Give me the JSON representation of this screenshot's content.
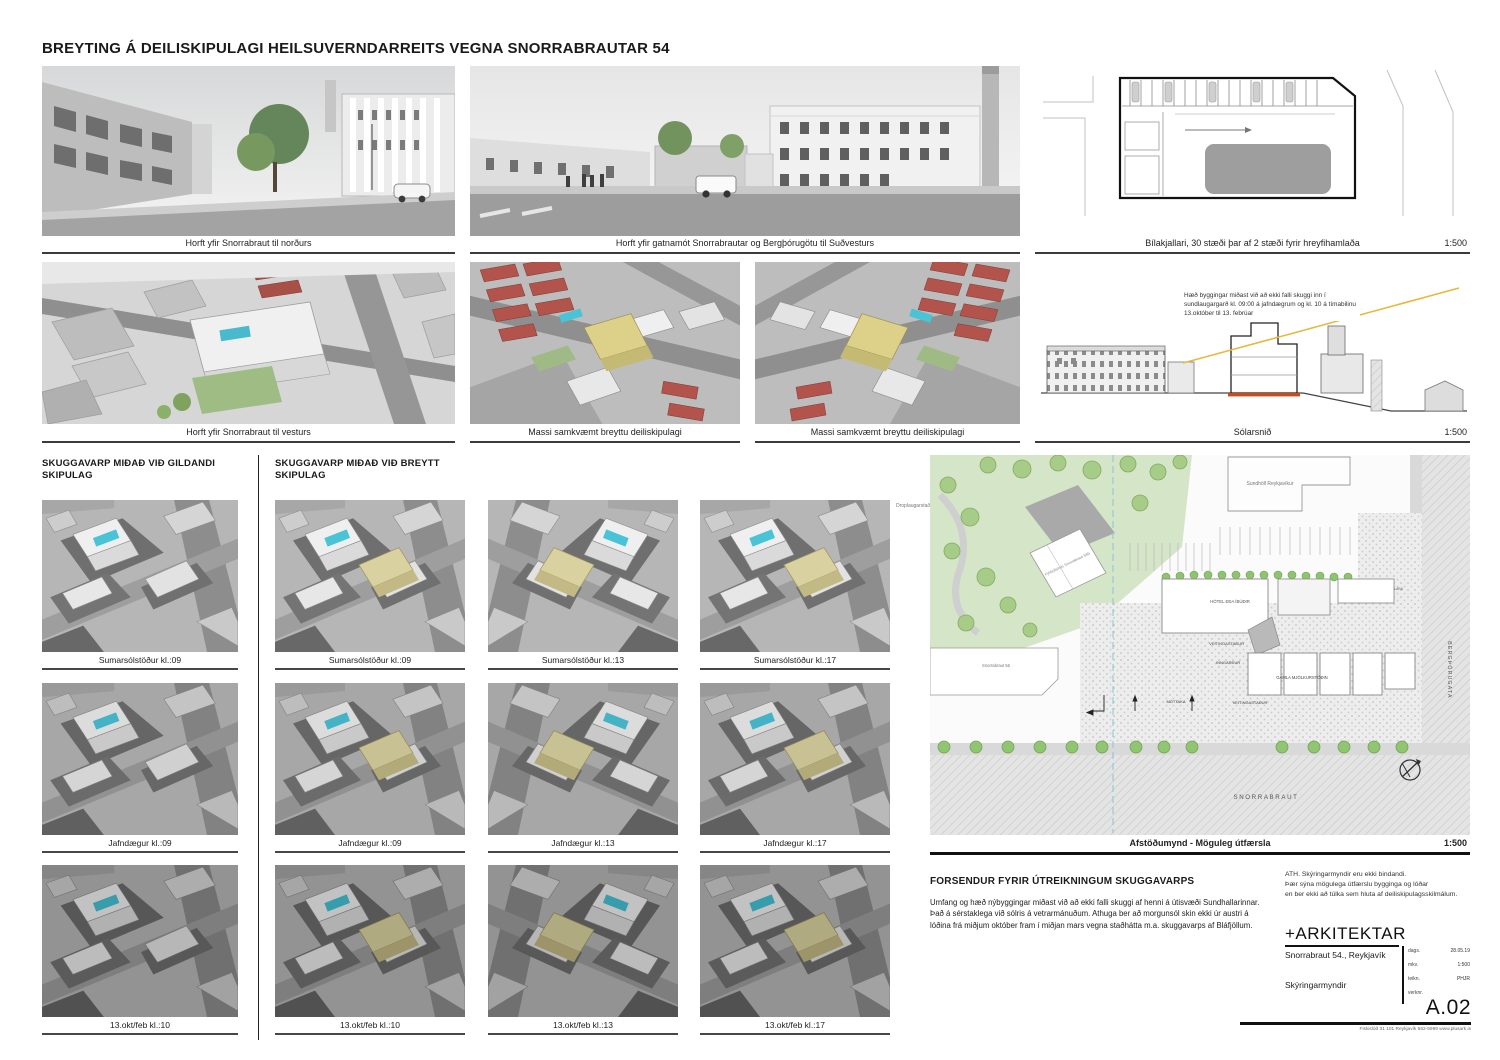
{
  "page": {
    "title": "BREYTING Á DEILISKIPULAGI HEILSUVERNDARREITS VEGNA SNORRABRAUTAR 54"
  },
  "top_row": {
    "render1_caption": "Horft yfir Snorrabraut til norðurs",
    "render2_caption": "Horft yfir gatnamót Snorrabrautar og Bergþórugötu til Suðvesturs",
    "garage_caption": "Bílakjallari, 30 stæði þar af 2 stæði fyrir hreyfihamlaða",
    "garage_scale": "1:500"
  },
  "second_row": {
    "render3_caption": "Horft yfir Snorrabraut til vesturs",
    "mass1_caption": "Massi samkvæmt breyttu deiliskipulagi",
    "mass2_caption": "Massi samkvæmt breyttu deiliskipulagi",
    "sun_section": {
      "annotation": "Hæð byggingar miðast við að ekki falli skuggi inn í sundlaugargarð kl. 09:00 á jafndægrum og kl. 10 á tímabilinu 13.október til 13. febrúar",
      "caption": "Sólarsnið",
      "scale": "1:500"
    }
  },
  "shadow_existing": {
    "heading": "SKUGGAVARP MIÐAÐ VIÐ GILDANDI SKIPULAG",
    "captions": [
      "Sumarsólstöður kl.:09",
      "Jafndægur kl.:09",
      "13.okt/feb kl.:10"
    ]
  },
  "shadow_changed": {
    "heading": "SKUGGAVARP MIÐAÐ VIÐ BREYTT SKIPULAG",
    "captions": [
      [
        "Sumarsólstöður kl.:09",
        "Sumarsólstöður kl.:13",
        "Sumarsólstöður kl.:17"
      ],
      [
        "Jafndægur kl.:09",
        "Jafndægur kl.:13",
        "Jafndægur kl.:17"
      ],
      [
        "13.okt/feb kl.:10",
        "13.okt/feb kl.:13",
        "13.okt/feb kl.:17"
      ]
    ]
  },
  "site_plan": {
    "caption": "Afstöðumynd - Möguleg útfærsla",
    "scale": "1:500",
    "labels": {
      "droplaugarstadir": "Droplaugarstaðir",
      "sundholl": "Sundhöll Reykjavíkur",
      "fjolbylishus": "Fjölbýlishús Snorrabraut 56b",
      "snorrabraut56": "Snorrabraut 56",
      "hotel": "HÓTEL EÐA ÍBÚÐIR",
      "inn_ut": "INN- OG ÚTAKEYRSLA BÍLAKJALLARA",
      "veitingastadur1": "VEITINGASTAÐUR",
      "veitingastadur2": "VEITINGASTAÐUR",
      "inngardur": "INNGARÐUR",
      "gamla_mjolkurstodin": "GAMLA MJÓLKURSTÖÐIN",
      "mottaka": "MÓTTAKA",
      "snorrabraut_street": "SNORRABRAUT",
      "bergthorugata": "BERGÞÓRUGATA"
    }
  },
  "forsendur": {
    "heading": "FORSENDUR FYRIR ÚTREIKNINGUM SKUGGAVARPS",
    "body": "Umfang og hæð nýbyggingar miðast við að ekki falli skuggi af henni á útisvæði Sundhallarinnar. Það á sérstaklega við sólris á vetrarmánuðum. Athuga ber að morgunsól skin ekki úr austri á lóðina frá miðjum október fram í miðjan mars vegna staðhátta m.a. skuggavarps af Bláfjöllum."
  },
  "note": {
    "line1": "ATH. Skýringarmyndir eru ekki bindandi.",
    "line2": "Þær sýna mögulega útfærslu bygginga og lóðar",
    "line3": "en ber ekki að túlka sem hluta af deiliskipulagsskilmálum."
  },
  "title_block": {
    "firm": "+ARKITEKTAR",
    "project": "Snorrabraut 54., Reykjavík",
    "sheet_name": "Skýringarmyndir",
    "fields": [
      {
        "label": "dags.",
        "value": "28.05.19"
      },
      {
        "label": "mkv.",
        "value": "1:500"
      },
      {
        "label": "teikn.",
        "value": "PHJR"
      },
      {
        "label": "verknr.",
        "value": ""
      }
    ],
    "sheet_number": "A.02",
    "footer": "Fiskislóð 31   101 Reykjavík   562-5999   www.plusark.is"
  },
  "colors": {
    "pool_cyan": "#49c3d6",
    "new_mass_khaki": "#d9d2a0",
    "park_green": "#d5e6c8",
    "roof_red": "#b2544b",
    "sun_line_gold": "#e6b93f"
  }
}
